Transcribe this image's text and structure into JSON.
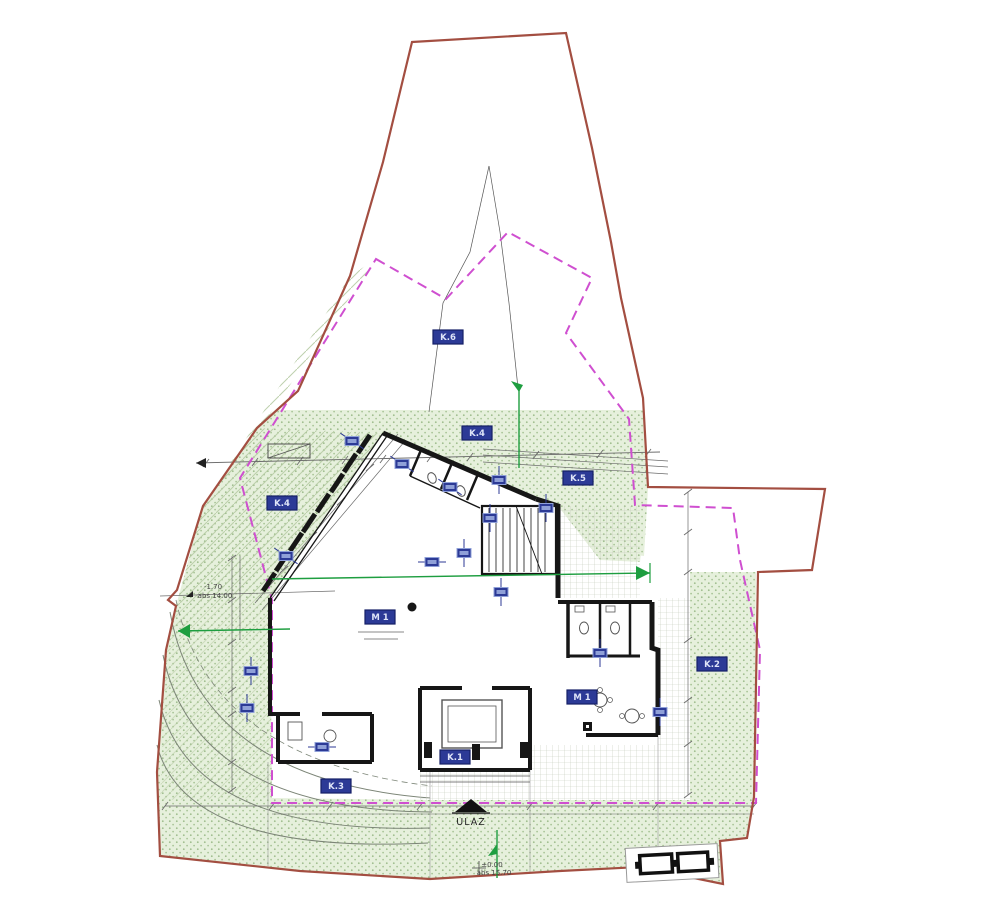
{
  "annotations": {
    "entrance_label": "ULAZ",
    "entrance_level": "±0.00",
    "entrance_abs": "abs 15.70",
    "west_level": "-1.70",
    "west_abs": "abs 14.00"
  },
  "labels": [
    {
      "text": "K.6",
      "x": 448,
      "y": 337
    },
    {
      "text": "K.4",
      "x": 477,
      "y": 433
    },
    {
      "text": "K.4",
      "x": 282,
      "y": 503
    },
    {
      "text": "K.5",
      "x": 578,
      "y": 478
    },
    {
      "text": "K.2",
      "x": 712,
      "y": 664
    },
    {
      "text": "K.3",
      "x": 336,
      "y": 786
    },
    {
      "text": "K.1",
      "x": 455,
      "y": 757
    },
    {
      "text": "M 1",
      "x": 380,
      "y": 617
    },
    {
      "text": "M 1",
      "x": 582,
      "y": 697
    }
  ],
  "markers": [
    {
      "x": 352,
      "y": 441,
      "a": -56
    },
    {
      "x": 402,
      "y": 464,
      "a": -56
    },
    {
      "x": 450,
      "y": 487,
      "a": -56
    },
    {
      "x": 499,
      "y": 480,
      "a": 0
    },
    {
      "x": 546,
      "y": 508,
      "a": 0
    },
    {
      "x": 490,
      "y": 518,
      "a": 0
    },
    {
      "x": 464,
      "y": 553,
      "a": 0
    },
    {
      "x": 432,
      "y": 562,
      "a": 90
    },
    {
      "x": 286,
      "y": 556,
      "a": -56
    },
    {
      "x": 251,
      "y": 671,
      "a": 0
    },
    {
      "x": 247,
      "y": 708,
      "a": 0
    },
    {
      "x": 322,
      "y": 747,
      "a": 90
    },
    {
      "x": 600,
      "y": 653,
      "a": 0
    },
    {
      "x": 660,
      "y": 712,
      "a": 0
    },
    {
      "x": 501,
      "y": 592,
      "a": 0
    }
  ],
  "colors": {
    "boundary": "#a34e41",
    "setback": "#cf4fd0",
    "label_blue": "#2c3a96",
    "label_blue_dark": "#141f66",
    "tag_inner": "#8fa0d8",
    "dim_green": "#1e9e40",
    "wall": "#161616",
    "veg_bg": "#e6f0dc",
    "veg_dot": "#9fbd8d",
    "hatch": "#b6cba4",
    "grid": "#c3c9ba",
    "gray": "#6b6b6b"
  }
}
